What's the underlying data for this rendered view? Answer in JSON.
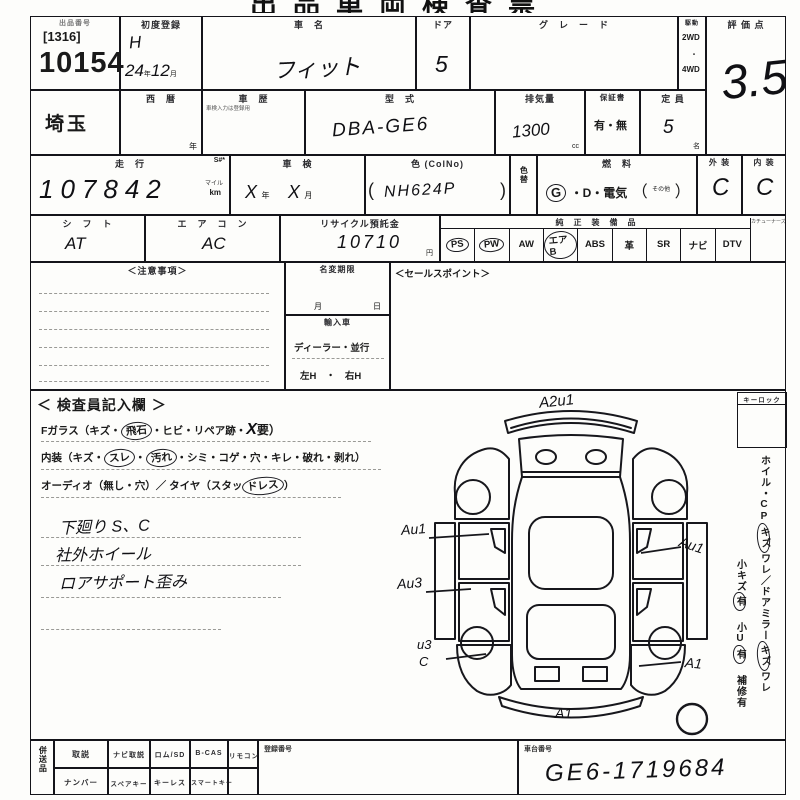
{
  "title_cut": "出品車両検査票",
  "lot": {
    "label": "出品番号",
    "bracket": "[1316]",
    "number": "10154"
  },
  "first_reg": {
    "label": "初度登録",
    "era": "H",
    "year": "24",
    "year_u": "年",
    "month": "12",
    "month_u": "月"
  },
  "car_name": {
    "label": "車　名",
    "value": "フィット"
  },
  "door": {
    "label": "ドア",
    "value": "5"
  },
  "grade": {
    "label": "グ　レ　ー　ド",
    "value": ""
  },
  "drive": {
    "label": "駆動",
    "opt1": "2WD",
    "sep": "・",
    "opt2": "4WD"
  },
  "score": {
    "label": "評 価 点",
    "value": "3.5"
  },
  "prefecture": "埼玉",
  "seireki": {
    "label": "西　暦",
    "unit": "年"
  },
  "shareki": {
    "label": "車　歴",
    "note": "車検入力は登録用"
  },
  "katashiki": {
    "label": "型　式",
    "value": "DBA-GE6"
  },
  "haikiryo": {
    "label": "排気量",
    "value": "1300",
    "unit": "cc"
  },
  "hosho": {
    "label": "保証書",
    "value": "有・無"
  },
  "teiin": {
    "label": "定 員",
    "value": "5",
    "unit": "名"
  },
  "mileage": {
    "label": "走　行",
    "s_label": "S#*",
    "value": "107842",
    "unit1": "マイル",
    "unit2": "km"
  },
  "shaken": {
    "label": "車　検",
    "v1": "X",
    "u1": "年",
    "v2": "X",
    "u2": "月"
  },
  "color": {
    "label": "色 (ColNo)",
    "open": "(",
    "value": "NH624P",
    "close": ")"
  },
  "color_change": {
    "label": "色替"
  },
  "fuel": {
    "label": "燃　料",
    "g": "G",
    "rest": "・D・電気",
    "open": "（",
    "other": "その他",
    "close": "）"
  },
  "exterior": {
    "label": "外 装",
    "value": "C"
  },
  "interior": {
    "label": "内 装",
    "value": "C"
  },
  "shift": {
    "label": "シ　フ　ト",
    "value": "AT"
  },
  "aircon": {
    "label": "エ　ア　コ　ン",
    "value": "AC"
  },
  "recycle": {
    "label": "リサイクル預託金",
    "value": "10710",
    "unit": "円"
  },
  "equipment": {
    "label": "純　正　装　備　品",
    "side_note": "カチューナーズ",
    "items": [
      {
        "label": "PS",
        "circled": true
      },
      {
        "label": "PW",
        "circled": true
      },
      {
        "label": "AW",
        "circled": false
      },
      {
        "label": "エアB",
        "circled": true
      },
      {
        "label": "ABS",
        "circled": false
      },
      {
        "label": "革",
        "circled": false
      },
      {
        "label": "SR",
        "circled": false
      },
      {
        "label": "ナビ",
        "circled": false
      },
      {
        "label": "DTV",
        "circled": false
      }
    ]
  },
  "notice": {
    "label": "＜注意事項＞"
  },
  "namechange": {
    "label": "名変期限",
    "month": "月",
    "day": "日"
  },
  "importcar": {
    "label": "輸入車",
    "row1": "ディーラー・並行",
    "row2": "左H　・　右H"
  },
  "sales": {
    "label": "＜セールスポイント＞"
  },
  "inspector": {
    "header": "＜ 検査員記入欄 ＞",
    "fglass": {
      "p1": "Fガラス（キズ・",
      "c1": "飛石",
      "p2": "・ヒビ・リペア跡・",
      "hand": "X",
      "p3": "要）"
    },
    "interior_line": {
      "p1": "内装（キズ・",
      "c1": "スレ",
      "p2": "・",
      "c2": "汚れ",
      "p3": "・シミ・コゲ・穴・キレ・破れ・剥れ）"
    },
    "audio_line": {
      "p1": "オーディオ（無し・穴）／ タイヤ（スタッ",
      "c1": "ドレス",
      "p2": "）"
    },
    "notes": [
      "下廻り S、C",
      "社外ホイール",
      "ロアサポート歪み"
    ]
  },
  "diagram": {
    "top": "A2u1",
    "left1": "Au1",
    "left2": "Au3",
    "left3": "u3",
    "left3b": "C",
    "right1": "Au1",
    "right2": "A1",
    "bottom": "A1"
  },
  "keylock": {
    "label": "キーロック"
  },
  "sidebar": {
    "line1": {
      "p1": "ホイル・CP",
      "c1": "キズ",
      "p2": "ワレ／ドアミラー",
      "c2": "キズ",
      "p3": "ワレ"
    },
    "line2": {
      "p1": "小キズ",
      "c1": "有",
      "p2": "　小U",
      "c2": "有",
      "p3": "　補修有"
    }
  },
  "bottom": {
    "group_label": "併送品",
    "row1": [
      "取説",
      "ナビ取説",
      "ロム/SD",
      "B-CAS",
      "リモコン"
    ],
    "row2": [
      "ナンバー",
      "スペアキー",
      "キーレス",
      "スマートキー",
      ""
    ],
    "reg_label": "登録番号",
    "chassis_label": "車台番号",
    "chassis_value": "GE6-1719684"
  }
}
